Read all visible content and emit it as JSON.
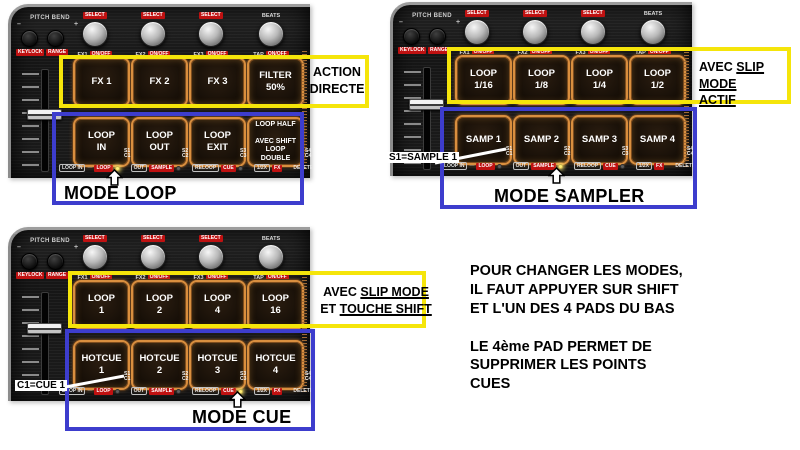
{
  "device": {
    "pitch_bend_label": "PITCH BEND",
    "pitch_minus": "–",
    "pitch_plus": "+",
    "pb_button_labels": [
      "KEYLOCK",
      "RANGE"
    ],
    "knob_select_label": "SELECT",
    "beats_label": "BEATS",
    "knob_names": [
      "FX1",
      "FX2",
      "FX3",
      "TAP"
    ],
    "knob_onoff_label": "ON/OFF",
    "legend": {
      "loop_in": "LOOP IN",
      "dash": "—",
      "loop": "LOOP",
      "out": "OUT",
      "sample": "SAMPLE",
      "reloop": "RELOOP",
      "cue": "CUE",
      "half": "1/2X",
      "fx": "FX",
      "delete": "DELETE"
    },
    "corner_labels": [
      {
        "s": "S1",
        "c": "C1"
      },
      {
        "s": "S2",
        "c": "C2"
      },
      {
        "s": "S3",
        "c": "C3"
      },
      {
        "s": "S4",
        "c": "C4"
      }
    ]
  },
  "panels": [
    {
      "id": "loop",
      "top_pads": [
        "FX 1",
        "FX 2",
        "FX 3",
        "FILTER\n50%"
      ],
      "bottom_pads": [
        "LOOP\nIN",
        "LOOP\nOUT",
        "LOOP\nEXIT",
        "LOOP HALF\n\nAVEC SHIFT\nLOOP\nDOUBLE"
      ],
      "yellow_note_line1": "ACTION",
      "yellow_note_line2": "DIRECTE",
      "blue_note": "MODE LOOP"
    },
    {
      "id": "sampler",
      "top_pads": [
        "LOOP\n1/16",
        "LOOP\n1/8",
        "LOOP\n1/4",
        "LOOP\n1/2"
      ],
      "bottom_pads": [
        "SAMP 1",
        "SAMP 2",
        "SAMP 3",
        "SAMP 4"
      ],
      "yellow_note_pre1": "AVEC ",
      "yellow_note_u1": "SLIP MODE",
      "yellow_note_pre2": "",
      "yellow_note_u2": "ACTIF",
      "blue_note": "MODE SAMPLER",
      "side_label": "S1=SAMPLE 1"
    },
    {
      "id": "cue",
      "top_pads": [
        "LOOP\n1",
        "LOOP\n2",
        "LOOP\n4",
        "LOOP\n16"
      ],
      "bottom_pads": [
        "HOTCUE\n1",
        "HOTCUE\n2",
        "HOTCUE\n3",
        "HOTCUE\n4"
      ],
      "yellow_note_pre1": "AVEC ",
      "yellow_note_u1": "SLIP MODE",
      "yellow_note_pre2": "ET ",
      "yellow_note_u2": "TOUCHE SHIFT",
      "blue_note": "MODE CUE",
      "side_label": "C1=CUE 1"
    }
  ],
  "info_text": {
    "para1": "POUR CHANGER LES MODES,\nIL FAUT APPUYER SUR SHIFT\nET L'UN DES 4 PADS DU BAS",
    "para2": "LE 4ème PAD PERMET DE\nSUPPRIMER LES POINTS\nCUES"
  },
  "colors": {
    "highlight_yellow": "#f5e50a",
    "highlight_blue": "#3d3dcd",
    "label_red": "#bf1111",
    "led_on": "#ffee77",
    "pad_glow_orange": "#d98f3f"
  }
}
